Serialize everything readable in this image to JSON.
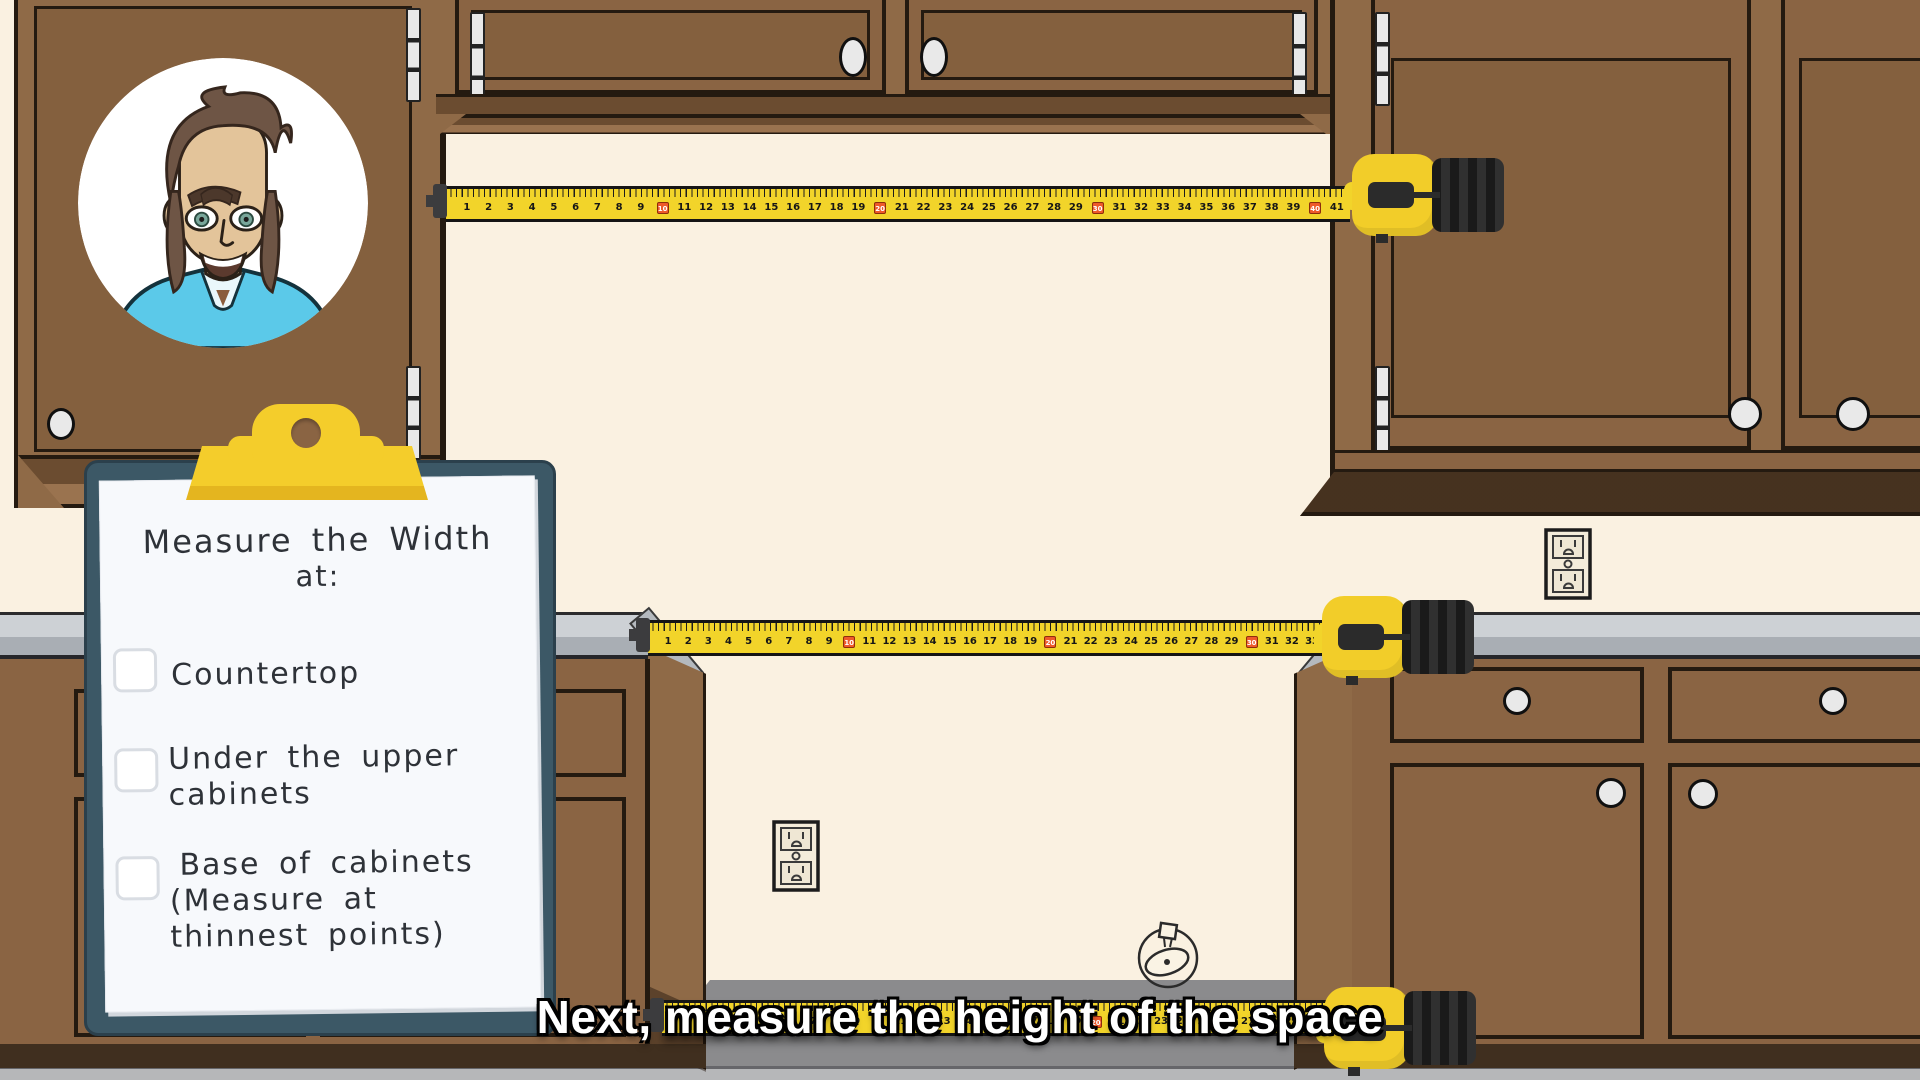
{
  "subtitle": "Next, measure the height of the space",
  "clipboard": {
    "title": [
      "Measure the Width",
      "at:"
    ],
    "items": [
      {
        "checked": false,
        "lines": [
          "Countertop"
        ]
      },
      {
        "checked": false,
        "lines": [
          "Under the upper",
          "cabinets"
        ]
      },
      {
        "checked": false,
        "lines": [
          "Base of cabinets",
          "(Measure at",
          "thinnest points)"
        ]
      }
    ]
  },
  "tapes": {
    "red_marker_every": 10,
    "instances": [
      {
        "id": "under-upper-cabinets-tape",
        "count": 41
      },
      {
        "id": "countertop-tape",
        "count": 33
      },
      {
        "id": "floor-tape",
        "count": 30
      }
    ]
  },
  "colors": {
    "wall": "#FAF1E1",
    "cabinet": "#8A6443",
    "cabinet_light": "#8F6A47",
    "cabinet_light2": "#9A734F",
    "cabinet_panel": "#84603E",
    "cabinet_dark": "#6B4C30",
    "outline": "#241A10",
    "toe": "#402F1F",
    "counter_top": "#CDD1D5",
    "counter_edge": "#A9AEB4",
    "floor": "#B6B7B9",
    "recess": "#8B8B8D",
    "board": "#3C5866",
    "clip": "#F4CD2B",
    "clip_dark": "#E4B51F",
    "paper": "#F7F9FC",
    "tape_yellow": "#F2D42A",
    "tape_red": "#EE5A2A",
    "knob": "#E9E9E9",
    "shirt": "#5BC9E9",
    "hair": "#6E5545",
    "skin": "#E3C49A"
  }
}
